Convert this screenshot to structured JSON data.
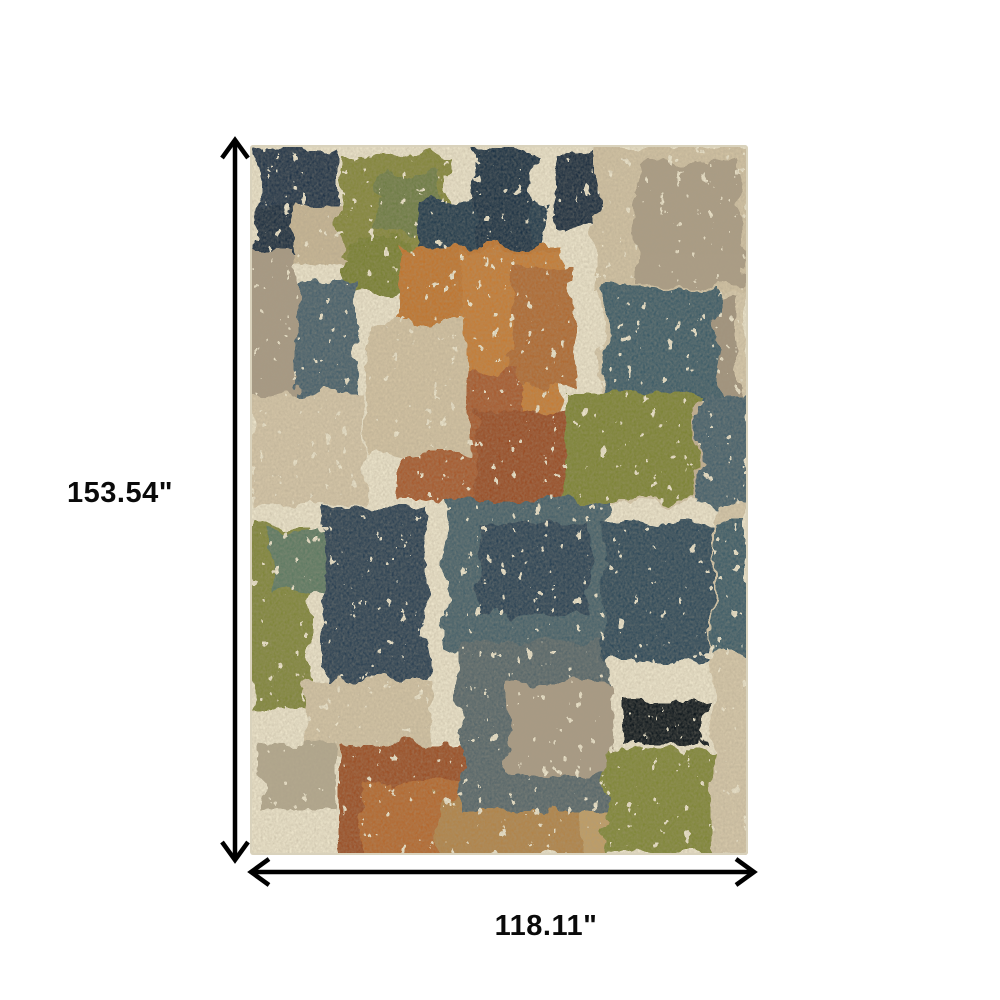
{
  "dimension_labels": {
    "height": "153.54\"",
    "width": "118.11\""
  },
  "arrows": {
    "color": "#000000"
  },
  "rug": {
    "base_color": "#ece4cb",
    "edge_color": "#d9d2bc",
    "palette_note": "distressed abstract patchwork rug",
    "patches": [
      {
        "x": 4,
        "y": 4,
        "w": 82,
        "h": 100,
        "c": "#22344a"
      },
      {
        "x": 28,
        "y": 58,
        "w": 104,
        "h": 62,
        "c": "#c7b695"
      },
      {
        "x": 4,
        "y": 58,
        "w": 42,
        "h": 52,
        "c": "#1d2f41"
      },
      {
        "x": 90,
        "y": 10,
        "w": 108,
        "h": 102,
        "c": "#84873b"
      },
      {
        "x": 128,
        "y": 28,
        "w": 64,
        "h": 62,
        "c": "#6e7d45"
      },
      {
        "x": 94,
        "y": 96,
        "w": 64,
        "h": 52,
        "c": "#788033"
      },
      {
        "x": 168,
        "y": 56,
        "w": 128,
        "h": 50,
        "c": "#243a4e"
      },
      {
        "x": 224,
        "y": 4,
        "w": 58,
        "h": 102,
        "c": "#1e3245"
      },
      {
        "x": 304,
        "y": 8,
        "w": 42,
        "h": 74,
        "c": "#1b2d3f"
      },
      {
        "x": 346,
        "y": 2,
        "w": 152,
        "h": 146,
        "c": "#d1c2a3"
      },
      {
        "x": 386,
        "y": 16,
        "w": 104,
        "h": 124,
        "c": "#ab9d85"
      },
      {
        "x": 350,
        "y": 146,
        "w": 148,
        "h": 212,
        "c": "#d6c8aa"
      },
      {
        "x": 366,
        "y": 150,
        "w": 120,
        "h": 98,
        "c": "#a1937d"
      },
      {
        "x": 436,
        "y": 254,
        "w": 62,
        "h": 102,
        "c": "#c2b092"
      },
      {
        "x": 150,
        "y": 102,
        "w": 160,
        "h": 150,
        "c": "#c0752f"
      },
      {
        "x": 212,
        "y": 106,
        "w": 98,
        "h": 246,
        "c": "#c57b34"
      },
      {
        "x": 262,
        "y": 120,
        "w": 60,
        "h": 120,
        "c": "#b06a33"
      },
      {
        "x": 148,
        "y": 226,
        "w": 124,
        "h": 130,
        "c": "#a75a2d"
      },
      {
        "x": 226,
        "y": 266,
        "w": 94,
        "h": 90,
        "c": "#994e27"
      },
      {
        "x": 0,
        "y": 106,
        "w": 44,
        "h": 144,
        "c": "#a79983"
      },
      {
        "x": 44,
        "y": 136,
        "w": 64,
        "h": 220,
        "c": "#46616c"
      },
      {
        "x": 116,
        "y": 176,
        "w": 102,
        "h": 132,
        "c": "#d2c2a2"
      },
      {
        "x": 0,
        "y": 250,
        "w": 114,
        "h": 110,
        "c": "#d4c5a7"
      },
      {
        "x": 354,
        "y": 142,
        "w": 114,
        "h": 110,
        "c": "#3e5b67"
      },
      {
        "x": 316,
        "y": 248,
        "w": 132,
        "h": 108,
        "c": "#7d8435"
      },
      {
        "x": 450,
        "y": 246,
        "w": 48,
        "h": 114,
        "c": "#45616c"
      },
      {
        "x": 0,
        "y": 382,
        "w": 60,
        "h": 182,
        "c": "#80863a"
      },
      {
        "x": 22,
        "y": 386,
        "w": 58,
        "h": 62,
        "c": "#5c7962"
      },
      {
        "x": 74,
        "y": 362,
        "w": 102,
        "h": 184,
        "c": "#2a4153"
      },
      {
        "x": 56,
        "y": 534,
        "w": 124,
        "h": 76,
        "c": "#d2c3a4"
      },
      {
        "x": 8,
        "y": 598,
        "w": 78,
        "h": 66,
        "c": "#b3a88e"
      },
      {
        "x": 90,
        "y": 600,
        "w": 142,
        "h": 110,
        "c": "#9b4f28"
      },
      {
        "x": 112,
        "y": 636,
        "w": 100,
        "h": 74,
        "c": "#b4672e"
      },
      {
        "x": 190,
        "y": 652,
        "w": 144,
        "h": 58,
        "c": "#b18448"
      },
      {
        "x": 328,
        "y": 654,
        "w": 60,
        "h": 56,
        "c": "#bf9d65"
      },
      {
        "x": 196,
        "y": 356,
        "w": 162,
        "h": 152,
        "c": "#44606b"
      },
      {
        "x": 230,
        "y": 380,
        "w": 110,
        "h": 90,
        "c": "#2c4254"
      },
      {
        "x": 210,
        "y": 496,
        "w": 148,
        "h": 170,
        "c": "#56666b"
      },
      {
        "x": 258,
        "y": 538,
        "w": 102,
        "h": 92,
        "c": "#a89a84"
      },
      {
        "x": 354,
        "y": 380,
        "w": 134,
        "h": 138,
        "c": "#2d495a"
      },
      {
        "x": 374,
        "y": 554,
        "w": 84,
        "h": 46,
        "c": "#0f161d"
      },
      {
        "x": 356,
        "y": 604,
        "w": 110,
        "h": 106,
        "c": "#808739"
      },
      {
        "x": 462,
        "y": 356,
        "w": 36,
        "h": 354,
        "c": "#d5c7a9"
      },
      {
        "x": 464,
        "y": 378,
        "w": 34,
        "h": 132,
        "c": "#3e5b67"
      }
    ]
  }
}
